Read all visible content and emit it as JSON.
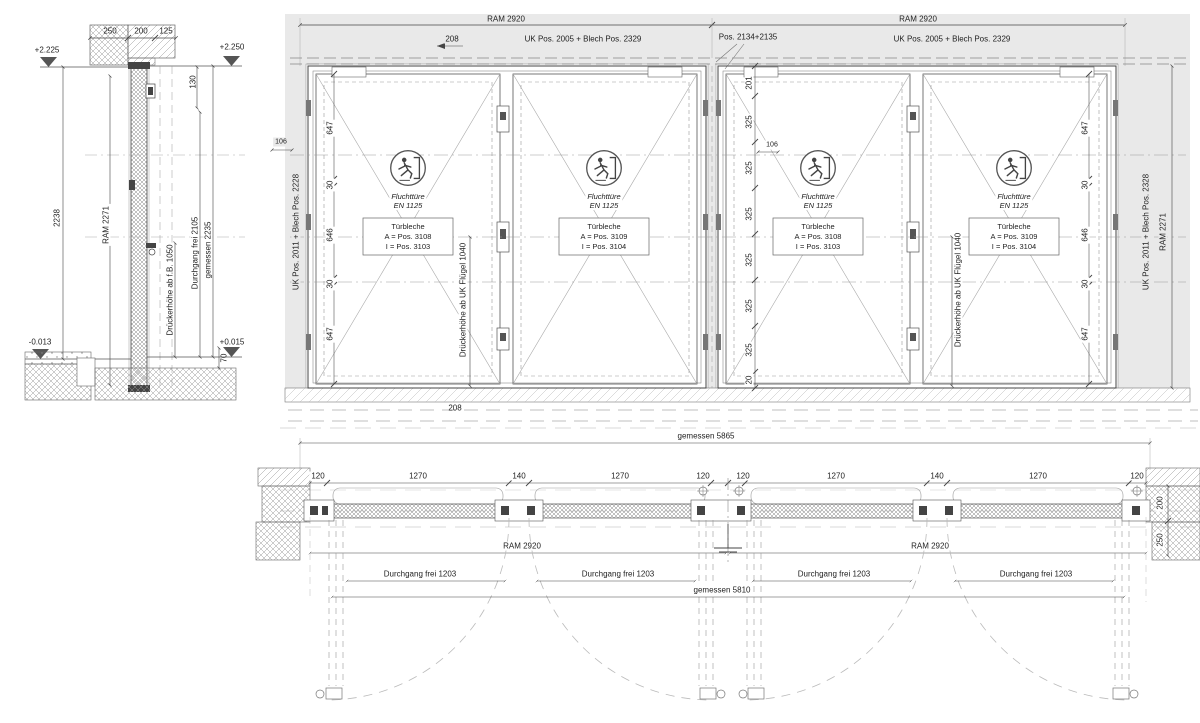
{
  "section": {
    "dims_top": [
      "250",
      "200",
      "125"
    ],
    "level_top_left": "+2.225",
    "level_top_right": "+2.250",
    "level_bottom_left": "-0.013",
    "level_bottom_right": "+0.015",
    "dim_130": "130",
    "dim_2238": "2238",
    "ram": "RAM 2271",
    "durchgang": "Durchgang frei 2105",
    "gemessen": "gemessen 2235",
    "drueckerhoehe": "Drückerhöhe ab f.B. 1050",
    "dim_70": "70"
  },
  "elevation": {
    "ram_left": "RAM 2920",
    "ram_right": "RAM 2920",
    "dim_208_top": "208",
    "uk_left": "UK Pos. 2005 + Blech Pos. 2329",
    "pos_center": "Pos. 2134+2135",
    "uk_right": "UK Pos. 2005 + Blech Pos. 2329",
    "side_left": "UK Pos. 2011 + Blech Pos. 2228",
    "side_right_uk": "UK Pos. 2011 + Blech Pos. 2328",
    "side_right_ram": "RAM 2271",
    "dim_106_left": "106",
    "dim_106_center": "106",
    "dim_201": "201",
    "dim_20": "20",
    "dims_325": [
      "325",
      "325",
      "325",
      "325",
      "325",
      "325"
    ],
    "left_dims": [
      "647",
      "30",
      "646",
      "30",
      "647"
    ],
    "right_dims": [
      "647",
      "30",
      "646",
      "30",
      "647"
    ],
    "drueckerhoehe_1": "Drückerhöhe ab UK Flügel 1040",
    "drueckerhoehe_2": "Drückerhöhe ab UK Flügel 1040",
    "dim_208_bottom": "208",
    "doors": [
      {
        "title": "Fluchttüre",
        "standard": "EN 1125",
        "plate_title": "Türbleche",
        "plate_a": "A = Pos. 3108",
        "plate_i": "I = Pos. 3103"
      },
      {
        "title": "Fluchttüre",
        "standard": "EN 1125",
        "plate_title": "Türbleche",
        "plate_a": "A = Pos. 3109",
        "plate_i": "I = Pos. 3104"
      },
      {
        "title": "Fluchttüre",
        "standard": "EN 1125",
        "plate_title": "Türbleche",
        "plate_a": "A = Pos. 3108",
        "plate_i": "I = Pos. 3103"
      },
      {
        "title": "Fluchttüre",
        "standard": "EN 1125",
        "plate_title": "Türbleche",
        "plate_a": "A = Pos. 3109",
        "plate_i": "I = Pos. 3104"
      }
    ]
  },
  "plan": {
    "gemessen_top": "gemessen 5865",
    "dims": [
      "120",
      "1270",
      "140",
      "1270",
      "120",
      "120",
      "1270",
      "140",
      "1270",
      "120"
    ],
    "ram_labels": [
      "RAM 2920",
      "RAM 2920"
    ],
    "durchgang_labels": [
      "Durchgang frei 1203",
      "Durchgang frei 1203",
      "Durchgang frei 1203",
      "Durchgang frei 1203"
    ],
    "gemessen_bottom": "gemessen 5810",
    "wall_dim_200": "200",
    "wall_dim_250": "250"
  },
  "colors": {
    "line": "#444444",
    "wall_band": "#e9e9e9"
  }
}
